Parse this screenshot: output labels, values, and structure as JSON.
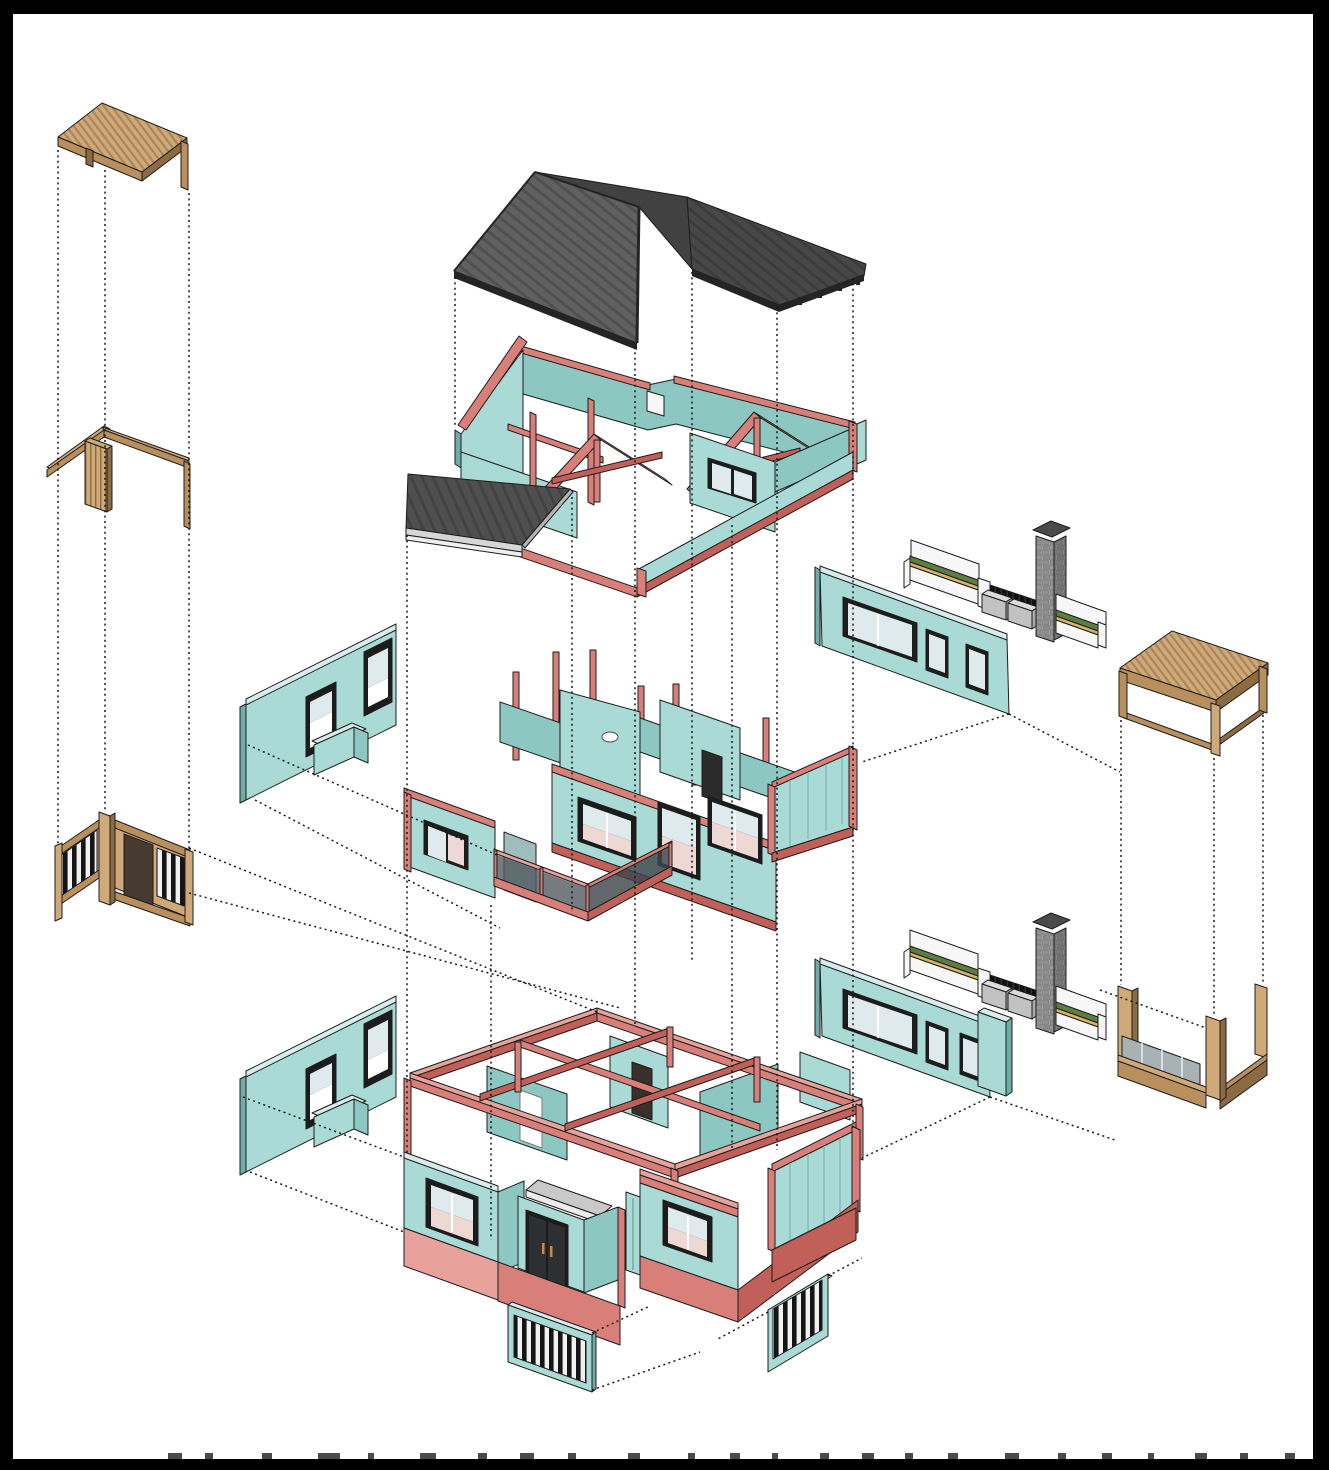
{
  "palette": {
    "paper": "#ffffff",
    "border_black": "#000000",
    "teal_light": "#a9dad6",
    "teal_mid": "#8cc7c2",
    "teal_dark": "#6fada8",
    "teal_top": "#d6edeb",
    "red_light": "#e9a19b",
    "red_mid": "#d97f79",
    "red_dark": "#c06058",
    "roof_slope": "#606060",
    "roof_stripe": "#505050",
    "roof_dark": "#414141",
    "roof_fascia": "#242424",
    "wood_light": "#cfa977",
    "wood_mid": "#b98f5e",
    "wood_dark": "#8c6a42",
    "stone_gray": "#9e9e9e",
    "planter_green": "#5c7e3e",
    "planter_tan": "#d8b367",
    "glass": "#dfeaec",
    "glass_pink": "#eed8d4",
    "window_frame": "#1c1c1c",
    "canopy_gray": "#d6d6d6",
    "slat_dark": "#151515"
  },
  "diagram": {
    "type": "exploded-axonometric-house",
    "components": [
      {
        "id": "pergola-canopy",
        "name": "wood slatted pergola canopy"
      },
      {
        "id": "pergola-frame",
        "name": "L-shaped wood pergola frame with slat screen"
      },
      {
        "id": "wood-fence-gate",
        "name": "wood corner fence with gate and balusters"
      },
      {
        "id": "main-roof",
        "name": "dark standing-seam gable roof"
      },
      {
        "id": "porch-roof",
        "name": "flat porch roof slab"
      },
      {
        "id": "attic-level",
        "name": "attic walls with red timber trusses"
      },
      {
        "id": "upper-wall-chimney-assembly",
        "name": "upper teal wall, planters, louver fence and stone chimney"
      },
      {
        "id": "middle-floor",
        "name": "upper storey walls with windows and balcony railing"
      },
      {
        "id": "left-wall-upper",
        "name": "teal facade panel with two windows and planter"
      },
      {
        "id": "wood-table-pergola",
        "name": "wood slat-top pergola frame"
      },
      {
        "id": "lower-wall-chimney-assembly",
        "name": "lower teal wall, planters, louver fence and stone chimney"
      },
      {
        "id": "left-wall-lower",
        "name": "teal facade panel with two windows and planter"
      },
      {
        "id": "wood-u-frame",
        "name": "U-shaped wood base frame with glass panels"
      },
      {
        "id": "ground-floor",
        "name": "ground storey walls, entry doors and red plinth"
      },
      {
        "id": "grille-panel-left",
        "name": "teal framed slat grille panel"
      },
      {
        "id": "grille-panel-right",
        "name": "teal framed slat grille panel"
      }
    ],
    "projection_lines": {
      "style": "dotted",
      "verticals": [
        [
          58,
          150,
          846
        ],
        [
          105,
          170,
          812
        ],
        [
          189,
          193,
          849
        ],
        [
          455,
          277,
          428
        ],
        [
          572,
          497,
          912
        ],
        [
          635,
          347,
          1026
        ],
        [
          692,
          272,
          962
        ],
        [
          732,
          525,
          1150
        ],
        [
          777,
          307,
          1150
        ],
        [
          853,
          278,
          1128
        ],
        [
          407,
          535,
          1155
        ],
        [
          491,
          905,
          1240
        ],
        [
          1121,
          720,
          985
        ],
        [
          1214,
          758,
          1015
        ],
        [
          1263,
          715,
          983
        ]
      ],
      "diagonals": [
        [
          189,
          848,
          597,
          1012
        ],
        [
          189,
          893,
          620,
          1008
        ],
        [
          248,
          745,
          497,
          855
        ],
        [
          255,
          800,
          500,
          928
        ],
        [
          243,
          1097,
          404,
          1157
        ],
        [
          250,
          1172,
          404,
          1232
        ],
        [
          1009,
          714,
          862,
          762
        ],
        [
          1009,
          714,
          1120,
          772
        ],
        [
          990,
          1097,
          862,
          1158
        ],
        [
          990,
          1097,
          1115,
          1140
        ],
        [
          1100,
          990,
          1206,
          1028
        ],
        [
          592,
          1333,
          650,
          1306
        ],
        [
          592,
          1390,
          700,
          1352
        ],
        [
          768,
          1312,
          716,
          1340
        ],
        [
          828,
          1276,
          862,
          1258
        ]
      ]
    },
    "footer_marks": [
      [
        168,
        14
      ],
      [
        205,
        8
      ],
      [
        262,
        10
      ],
      [
        318,
        22
      ],
      [
        368,
        6
      ],
      [
        420,
        16
      ],
      [
        478,
        9
      ],
      [
        520,
        14
      ],
      [
        568,
        8
      ],
      [
        628,
        12
      ],
      [
        688,
        7
      ],
      [
        730,
        10
      ],
      [
        772,
        6
      ],
      [
        820,
        9
      ],
      [
        862,
        12
      ],
      [
        905,
        8
      ],
      [
        948,
        10
      ],
      [
        1005,
        14
      ],
      [
        1058,
        8
      ],
      [
        1102,
        10
      ],
      [
        1148,
        6
      ],
      [
        1195,
        12
      ],
      [
        1240,
        8
      ],
      [
        1285,
        10
      ]
    ]
  }
}
